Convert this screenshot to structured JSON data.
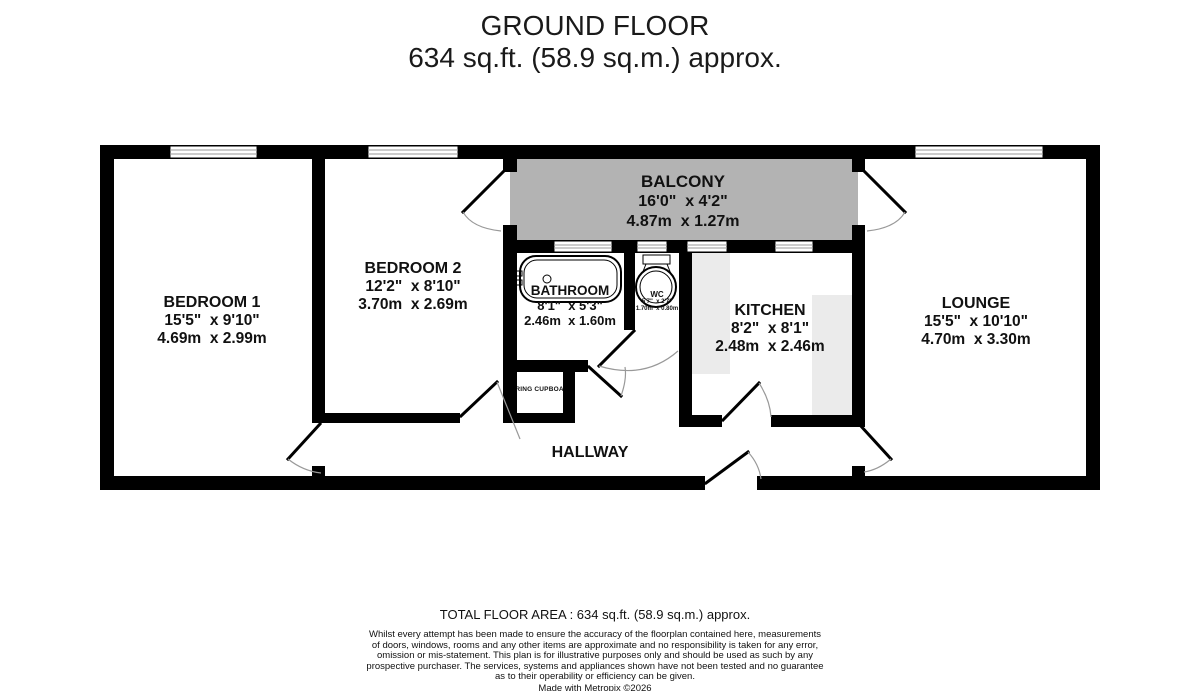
{
  "title": {
    "line1": "GROUND FLOOR",
    "line2": "634 sq.ft. (58.9 sq.m.) approx."
  },
  "rooms": {
    "balcony": {
      "name": "BALCONY",
      "imperial": "16'0\"  x 4'2\"",
      "metric": "4.87m  x 1.27m"
    },
    "bedroom1": {
      "name": "BEDROOM 1",
      "imperial": "15'5\"  x 9'10\"",
      "metric": "4.69m  x 2.99m"
    },
    "bedroom2": {
      "name": "BEDROOM 2",
      "imperial": "12'2\"  x 8'10\"",
      "metric": "3.70m  x 2.69m"
    },
    "bathroom": {
      "name": "BATHROOM",
      "imperial": "8'1\"  x 5'3\"",
      "metric": "2.46m  x 1.60m"
    },
    "wc": {
      "name": "WC",
      "imperial": "5'7\"  x 2'7\"",
      "metric": "1.70m  x 0.80m"
    },
    "kitchen": {
      "name": "KITCHEN",
      "imperial": "8'2\"  x 8'1\"",
      "metric": "2.48m  x 2.46m"
    },
    "lounge": {
      "name": "LOUNGE",
      "imperial": "15'5\"  x 10'10\"",
      "metric": "4.70m  x 3.30m"
    },
    "hallway": {
      "name": "HALLWAY"
    },
    "airing_cupboard": {
      "name": "AIRING CUPBOARD"
    }
  },
  "footer": {
    "total": "TOTAL FLOOR AREA : 634 sq.ft. (58.9 sq.m.) approx.",
    "disclaimer": "Whilst every attempt has been made to ensure the accuracy of the floorplan contained here, measurements\nof doors, windows, rooms and any other items are approximate and no responsibility is taken for any error,\nomission or mis-statement. This plan is for illustrative purposes only and should be used as such by any\nprospective purchaser. The services, systems and appliances shown have not been tested and no guarantee\nas to their operability or efficiency can be given.",
    "credit": "Made with Metropix ©2026"
  },
  "colors": {
    "wall": "#000000",
    "balcony_fill": "#b3b3b3",
    "counter_fill": "#ebebeb",
    "door_arc": "#999999"
  }
}
